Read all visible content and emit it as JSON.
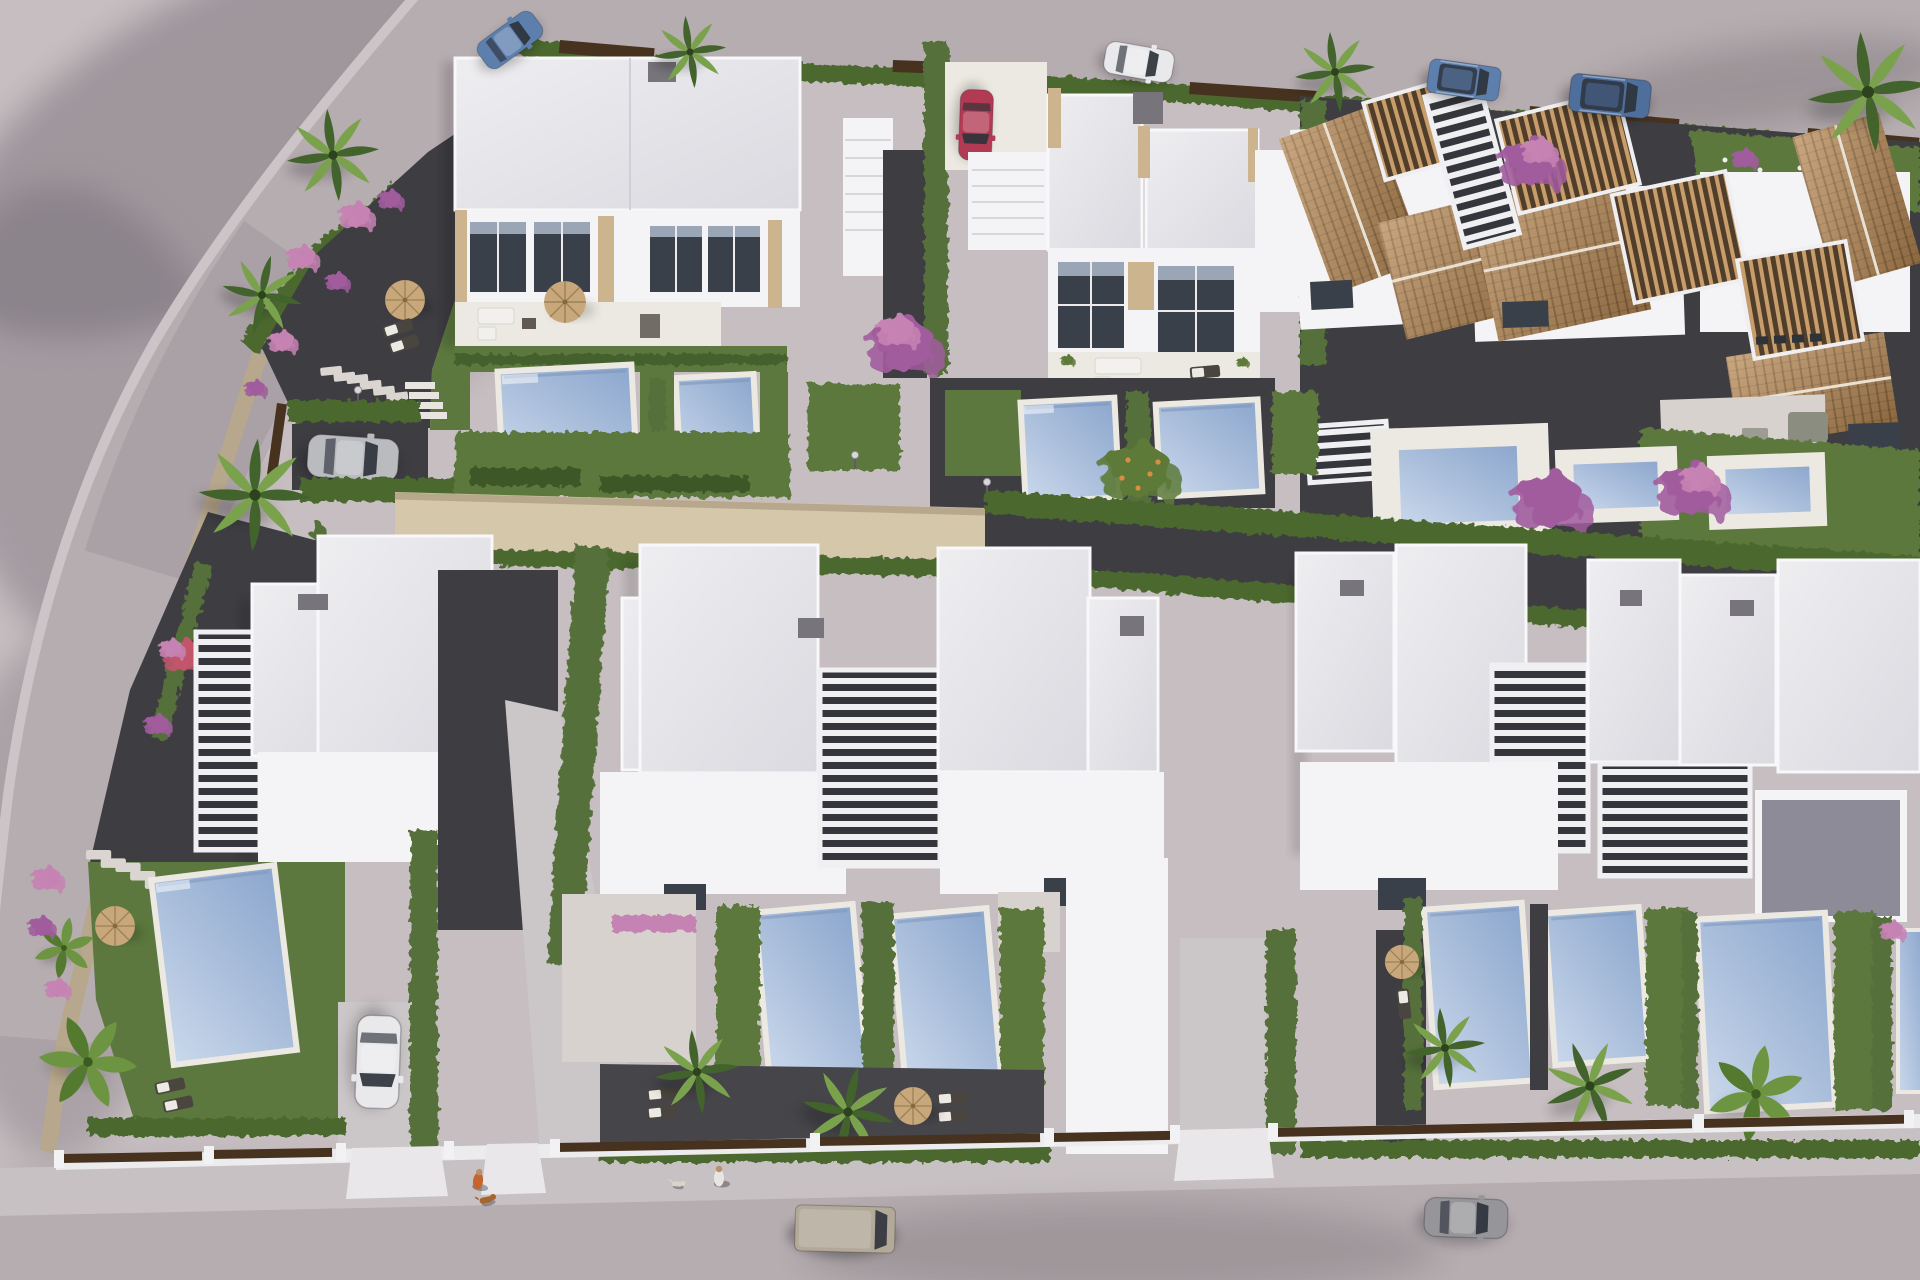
{
  "meta": {
    "title": "Aerial 3D render of a modern villa development",
    "description": "Bird's-eye architectural visualization: a curved access road, a row of white duplex villas with private pools, terracotta-roofed Mediterranean townhouses, a central gravel lane, and a lower row of white flat-roofed villas with pergola courts, lap pools, lawns and palm trees, bordered by a street with parked vehicles and pedestrians walking dogs."
  },
  "palette": {
    "terrain": "#c6bec0",
    "terrainShade": "#6f6772",
    "shadow": "#201d27",
    "roadMain": "#b6adb1",
    "roadEdge": "#ccc4c7",
    "sidewalk": "#c8c1c3",
    "curbWhite": "#ecebed",
    "wallStone": "#b7a78c",
    "pathSand": "#d5c7aa",
    "gravel": "#3e3d42",
    "gravelTer": "#46454a",
    "concrete": "#cbc6c8",
    "patio": "#d7d2ce",
    "courtGray": "#8e8b98",
    "grass": "#5c783e",
    "hedge": "#4c672f",
    "hedgeDark": "#3e5827",
    "cypress": "#55703a",
    "poolLight": "#cad8eb",
    "poolMid": "#a7bcda",
    "poolDeep": "#8ba6cd",
    "deck": "#ece9e2",
    "roofLight": "#eeedf0",
    "roofShade": "#dbdae0",
    "wallWhite": "#f4f3f5",
    "wallShade": "#dedce2",
    "windowDark": "#394049",
    "windowSky": "#9aa6b5",
    "stoneTrim": "#cbb48e",
    "terracotta": "#b98a55",
    "terracottaDark": "#926a3e",
    "ridge": "#e9e2d4",
    "woodSlat": "#c79e6b",
    "woodGap": "#503d2a",
    "woodDark": "#46321f",
    "pergolaGap": "#34363c",
    "slatWhite": "#f0f0f3",
    "acGray": "#77757b",
    "parasol": "#c8a87a",
    "parasolDark": "#9c8157",
    "furniture": "#4a463f",
    "towel": "#eceae4",
    "carBlue": "#5d7fae",
    "carBlue2": "#4e6e9c",
    "carRed": "#b23a52",
    "carSilver": "#babbbf",
    "carWhite": "#e9e9ec",
    "vanKhaki": "#b2a999",
    "carGray": "#96969a",
    "glass": "#2e333c",
    "skin": "#bb8f6c",
    "personOrange": "#c4642f",
    "personWhite": "#e8e6e2",
    "dogBrown": "#a5672e",
    "dogWhite": "#d9d4cc",
    "flowerPink": "#c583b3",
    "flowerPurple": "#a15c9d",
    "flowerCoral": "#c2556b",
    "treeGreen": "#5d7a38",
    "palmDark": "#42632c",
    "palmLight": "#7aa24c",
    "banana": "#6d9440",
    "fruitOrange": "#d98f3f",
    "lampGray": "#d8d8da"
  },
  "scene": {
    "setting": "new-build residential development, warm afternoon light, long soft shadows",
    "areas": {
      "access_road": "curved grey road sweeping along the top-left with a blue car",
      "upper_street": "street along the top edge with a white car and two blue SUVs parked",
      "top_row": "two white modern duplex villas with full-height glazing, stone trims, sun terraces and two pools each; Mediterranean townhouses with terracotta tiled roofs, timber pergolas and plunge pools on the right",
      "central_lane": "sand-coloured walled footpath turning into a dark gravel service lane lined with clipped hedges",
      "bottom_row": "four clusters of white flat-roofed villas with slatted pergola stair-courts, lap pools, lawns, gravel sun-decks, parasols and palms",
      "main_street": "lower street with pavement, low white walls with timber gate panels, pedestrians and parked vehicles"
    },
    "vehicles": [
      {
        "name": "blue-hatchback",
        "location": "curved access road, top left",
        "color_key": "carBlue"
      },
      {
        "name": "white-car-street",
        "location": "upper street",
        "color_key": "carWhite"
      },
      {
        "name": "blue-suv-1",
        "location": "upper street",
        "color_key": "carBlue"
      },
      {
        "name": "blue-suv-2",
        "location": "upper street",
        "color_key": "carBlue2"
      },
      {
        "name": "red-car",
        "location": "villa-2 parking pad",
        "color_key": "carRed"
      },
      {
        "name": "silver-car",
        "location": "parking bay behind villa-1 garden",
        "color_key": "carSilver"
      },
      {
        "name": "white-car-driveway",
        "location": "bottom-row villa driveway",
        "color_key": "carWhite"
      },
      {
        "name": "beige-van",
        "location": "main street",
        "color_key": "vanKhaki"
      },
      {
        "name": "grey-car",
        "location": "main street",
        "color_key": "carGray"
      }
    ],
    "people": [
      {
        "name": "pedestrian-1",
        "detail": "person in orange walking a brown dog on the pavement"
      },
      {
        "name": "pedestrian-2",
        "detail": "second person further along the pavement with a small white dog"
      }
    ],
    "counts": {
      "modern_villas_top": 2,
      "mediterranean_houses": 3,
      "bottom_villa_clusters": 4,
      "pools": 14,
      "parasols": 6,
      "palm_trees": 12,
      "sun_loungers": 10,
      "dogs": 2,
      "street_lamps": 3
    }
  }
}
